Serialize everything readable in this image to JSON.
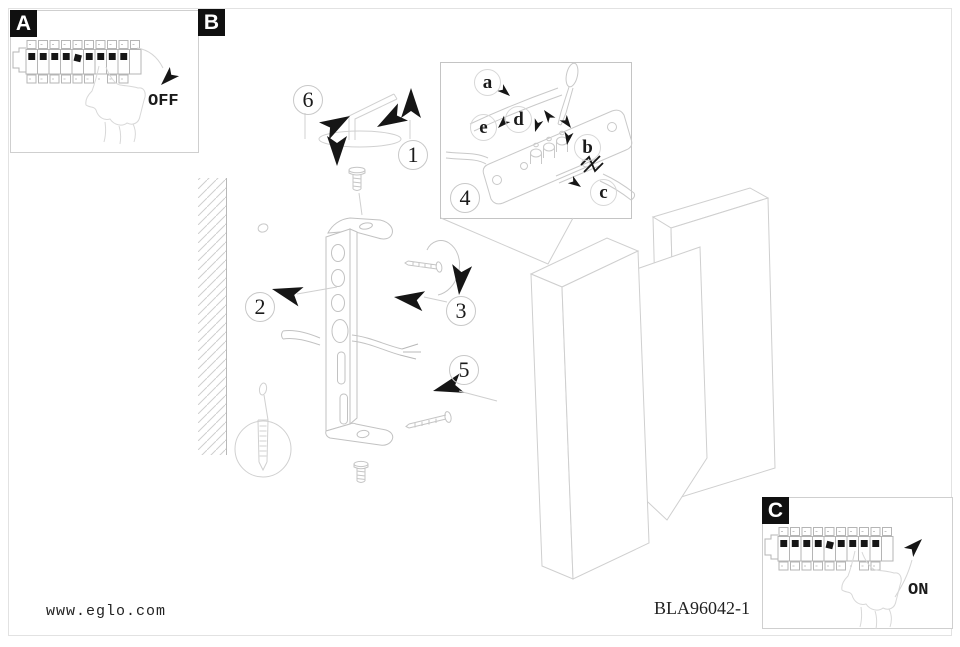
{
  "colors": {
    "line": "#c9c9c9",
    "faint": "#d8d8d8",
    "strip": "#b5b5b5",
    "ink": "#161616",
    "frame": "#e2e2e2"
  },
  "panels": {
    "a": {
      "label": "A",
      "switch_state": "OFF"
    },
    "b": {
      "label": "B"
    },
    "c": {
      "label": "C",
      "switch_state": "ON"
    }
  },
  "steps": {
    "s1": "1",
    "s2": "2",
    "s3": "3",
    "s4": "4",
    "s5": "5",
    "s6": "6"
  },
  "inset": {
    "step_label": "4",
    "terminals": {
      "a": "a",
      "b": "b",
      "c": "c",
      "d": "d",
      "e": "e"
    }
  },
  "footer": {
    "website": "www.eglo.com",
    "model": "BLA96042-1"
  }
}
